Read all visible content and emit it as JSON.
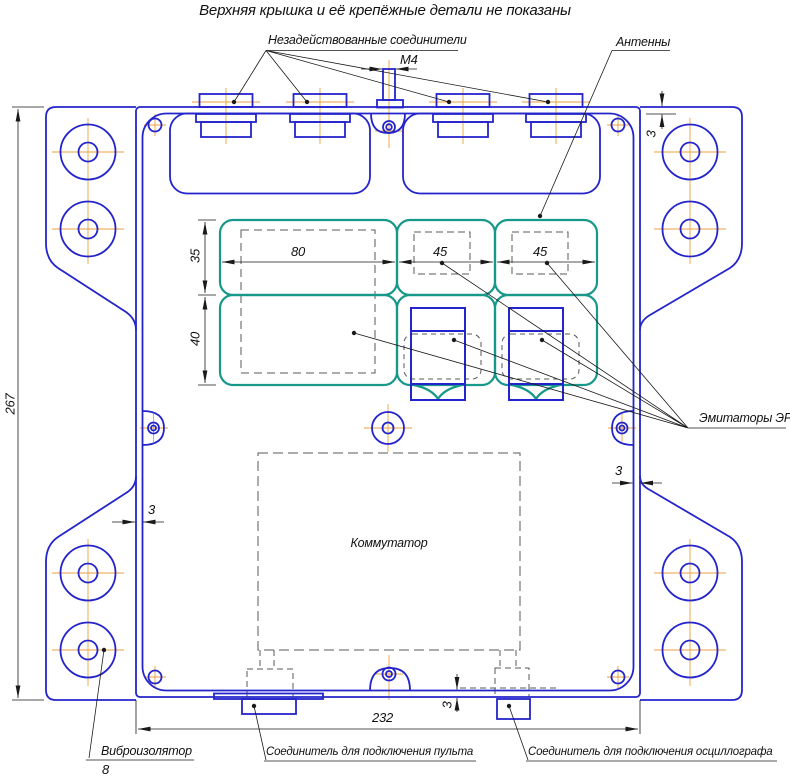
{
  "title": "Верхняя крышка и её крепёжные детали не показаны",
  "callouts": {
    "unused_connectors": "Незадействованные соединители",
    "antennas": "Антенны",
    "emitters": "Эмитаторы ЭРИ",
    "commutator": "Коммутатор",
    "vibro_isolator": "Виброизолятор",
    "vibro_position": "8",
    "console_connector": "Соединитель для подключения пульта",
    "oscilloscope_connector": "Соединитель для подключения осциллографа"
  },
  "dimensions": {
    "overall_height": "267",
    "inner_width": "232",
    "module_large_width": "80",
    "module_mid_width": "45",
    "module_right_width": "45",
    "module_row1_height": "35",
    "module_row2_height": "40",
    "wall_top": "3",
    "wall_left": "3",
    "wall_right": "3",
    "wall_bottom": "3",
    "thread": "М4"
  },
  "colors": {
    "outline": "#2424cc",
    "modules": "#17998a",
    "centerline": "#eba23c",
    "dims": "#1a1a1a"
  }
}
